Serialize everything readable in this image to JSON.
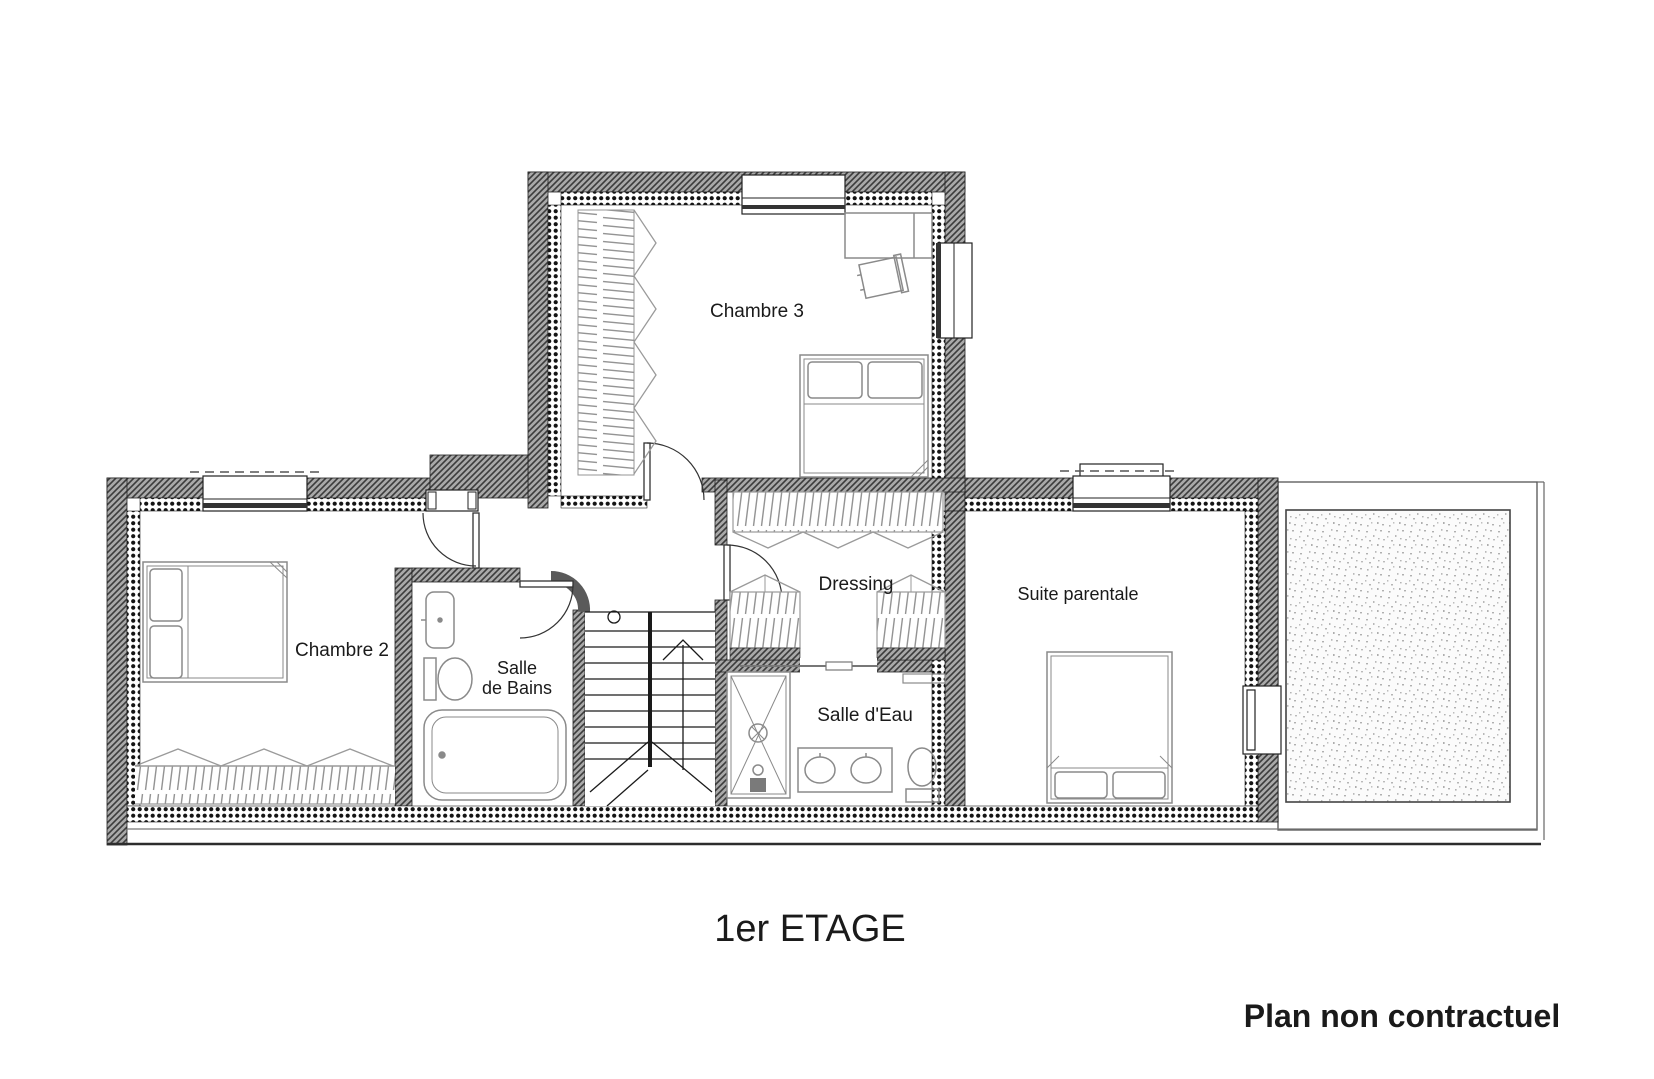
{
  "floorplan": {
    "title": "1er ETAGE",
    "disclaimer": "Plan non contractuel",
    "rooms": {
      "chambre2": "Chambre 2",
      "chambre3": "Chambre 3",
      "salle_de_bains_line1": "Salle",
      "salle_de_bains_line2": "de Bains",
      "dressing": "Dressing",
      "salle_deau": "Salle d'Eau",
      "suite_parentale": "Suite parentale"
    },
    "colors": {
      "wall_hatch_line": "#3c3c3c",
      "wall_hatch_base": "#a9a9a9",
      "furniture": "#8a8a8a",
      "ink": "#1a1a1a",
      "paper": "#ffffff"
    }
  }
}
